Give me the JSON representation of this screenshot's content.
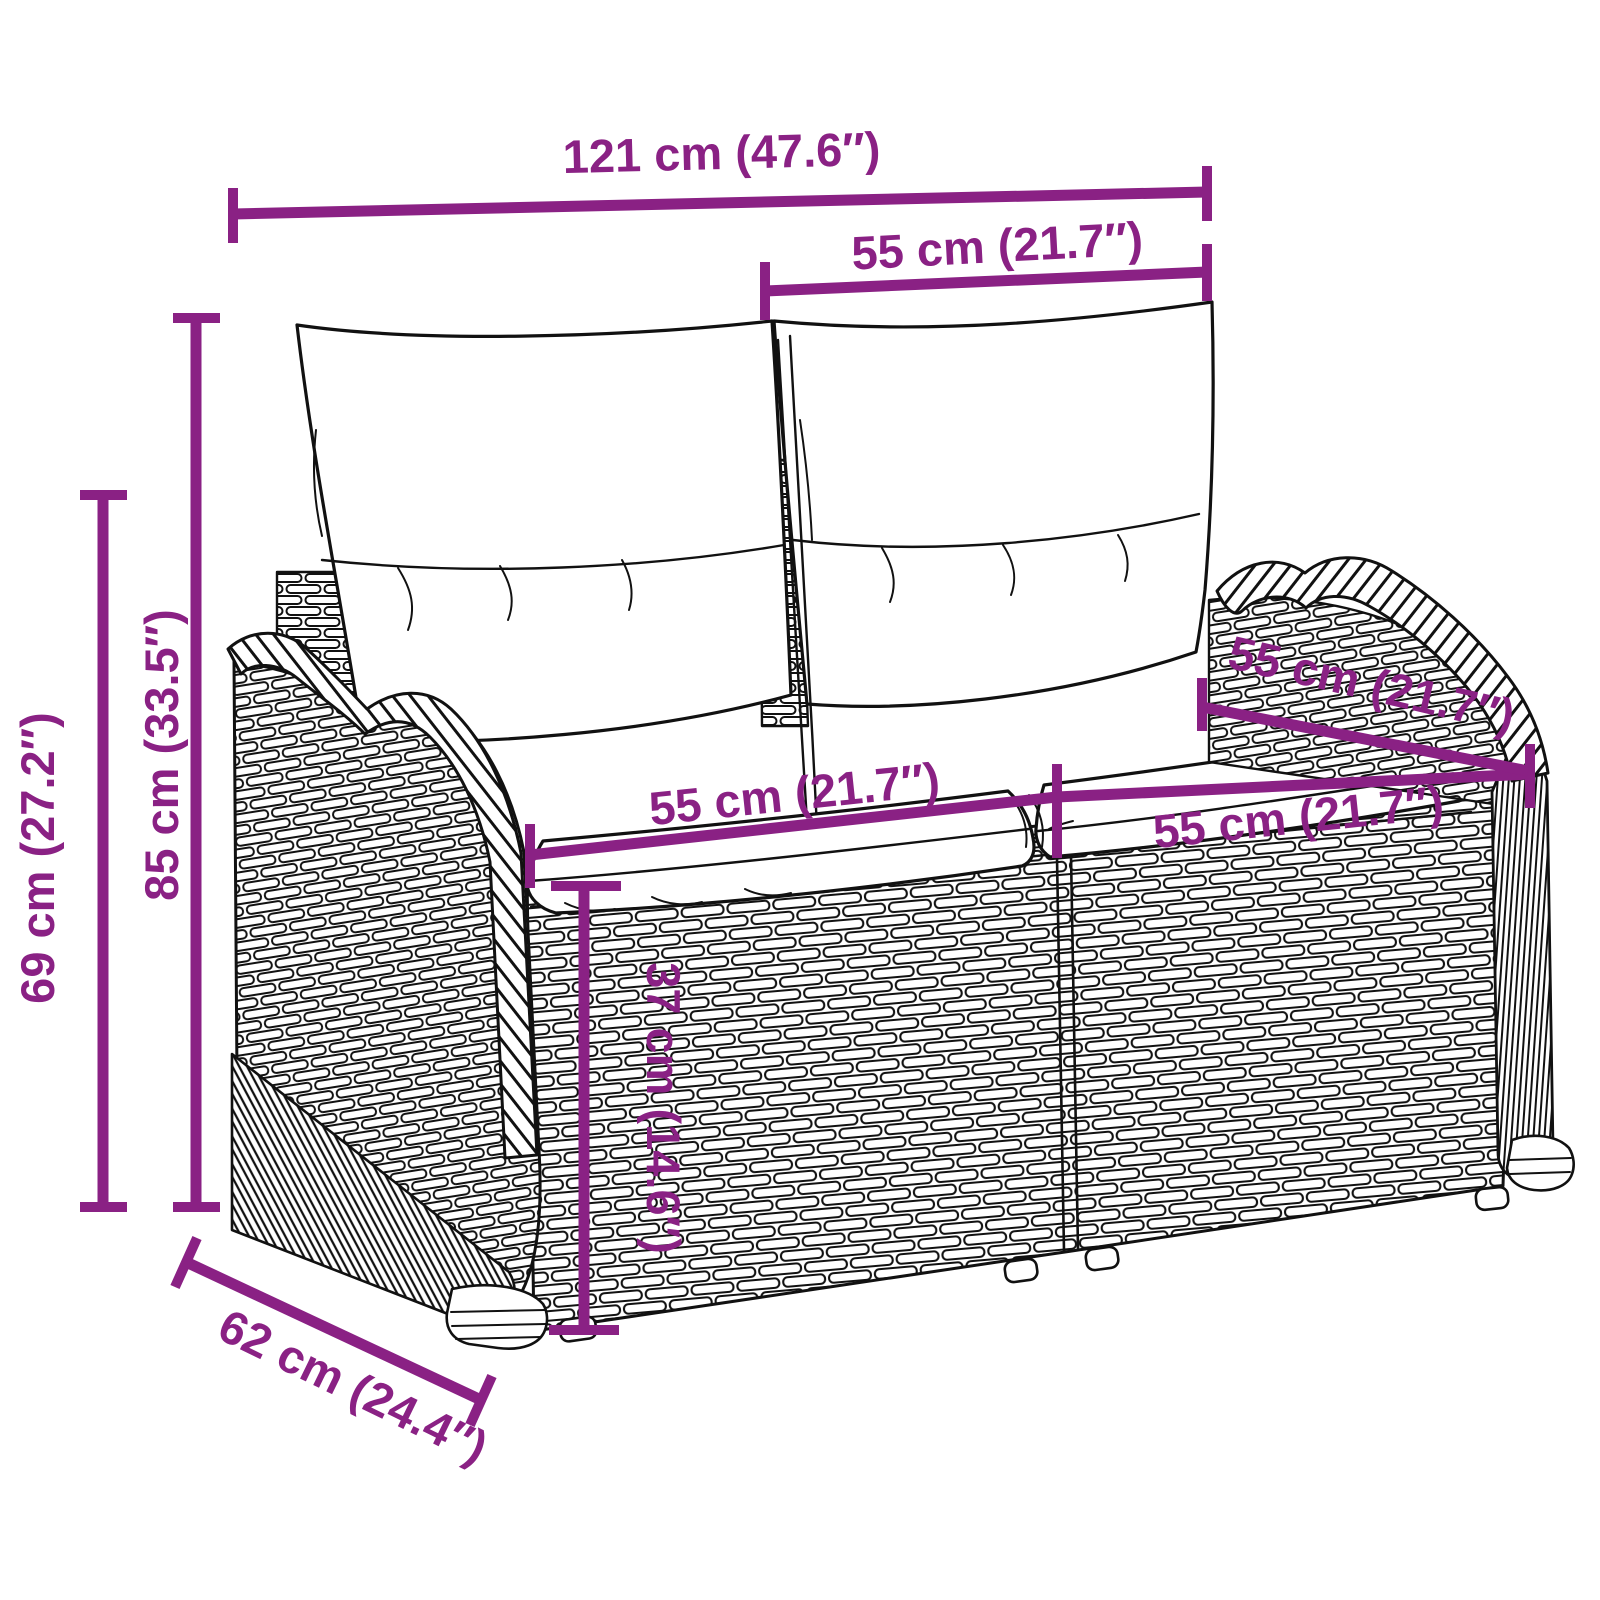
{
  "diagram": {
    "title": "rattan-garden-bench-dimension-diagram",
    "accent_color": "#8A2184",
    "line_color": "#111111",
    "background_color": "#FFFFFF",
    "dimensions": {
      "total_width": "121 cm (47.6″)",
      "back_cushion_width": "55 cm (21.7″)",
      "total_height": "85 cm (33.5″)",
      "armrest_height": "69 cm (27.2″)",
      "seat_width_left": "55 cm (21.7″)",
      "seat_width_right": "55 cm (21.7″)",
      "seat_depth": "55 cm (21.7″)",
      "seat_height": "37 cm (14.6″)",
      "base_depth": "62 cm (24.4″)"
    }
  }
}
